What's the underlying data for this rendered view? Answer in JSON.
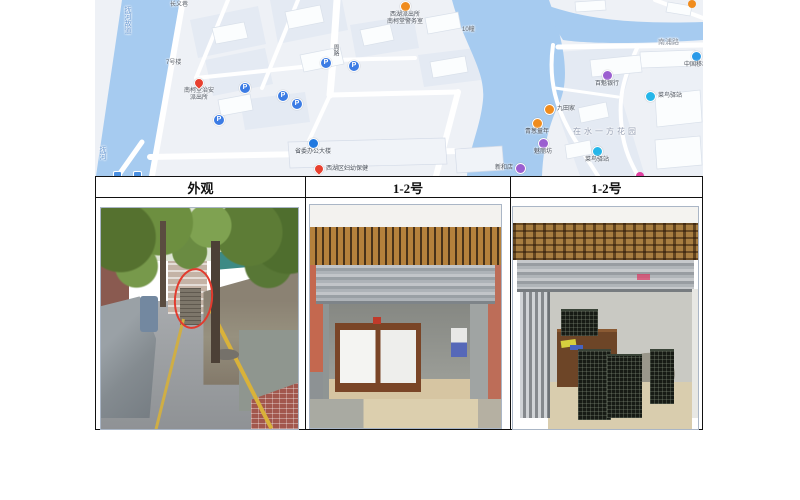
{
  "map": {
    "water_label_main": "抚河故道",
    "water_label_small": "抚河",
    "area_label": "在水一方花园",
    "road_labels": {
      "nanpu": "南浦路",
      "building10": "10幢",
      "building7": "7号楼",
      "alley": "长义巷",
      "vertical_road": "周路"
    },
    "parking_glyph": "P",
    "pois": [
      {
        "id": "police-workstation",
        "line1": "西湖派出所",
        "line2": "南柯堂警务室"
      },
      {
        "id": "police-station",
        "line1": "南柯堂治安",
        "line2": "派出所"
      },
      {
        "id": "gov-office",
        "label": "省委办公大楼"
      },
      {
        "id": "health-center",
        "label": "西湖区妇幼保健"
      },
      {
        "id": "bank",
        "label": "百魁银行"
      },
      {
        "id": "china-mobile",
        "label": "中国移动"
      },
      {
        "id": "cainiao-station-1",
        "label": "菜鸟驿站"
      },
      {
        "id": "restaurant",
        "label": "九田家"
      },
      {
        "id": "kids-store",
        "label": "青葱童年"
      },
      {
        "id": "beauty-store",
        "label": "魅丽坊"
      },
      {
        "id": "cainiao-station-2",
        "label": "菜鸟驿站"
      },
      {
        "id": "store-partial",
        "label": "新和店"
      }
    ],
    "colors": {
      "water": "#a6cbf0",
      "land": "#eef1f6",
      "parking_blue": "#3c7ce4"
    }
  },
  "table": {
    "headers": [
      "外观",
      "1-2号",
      "1-2号"
    ]
  }
}
